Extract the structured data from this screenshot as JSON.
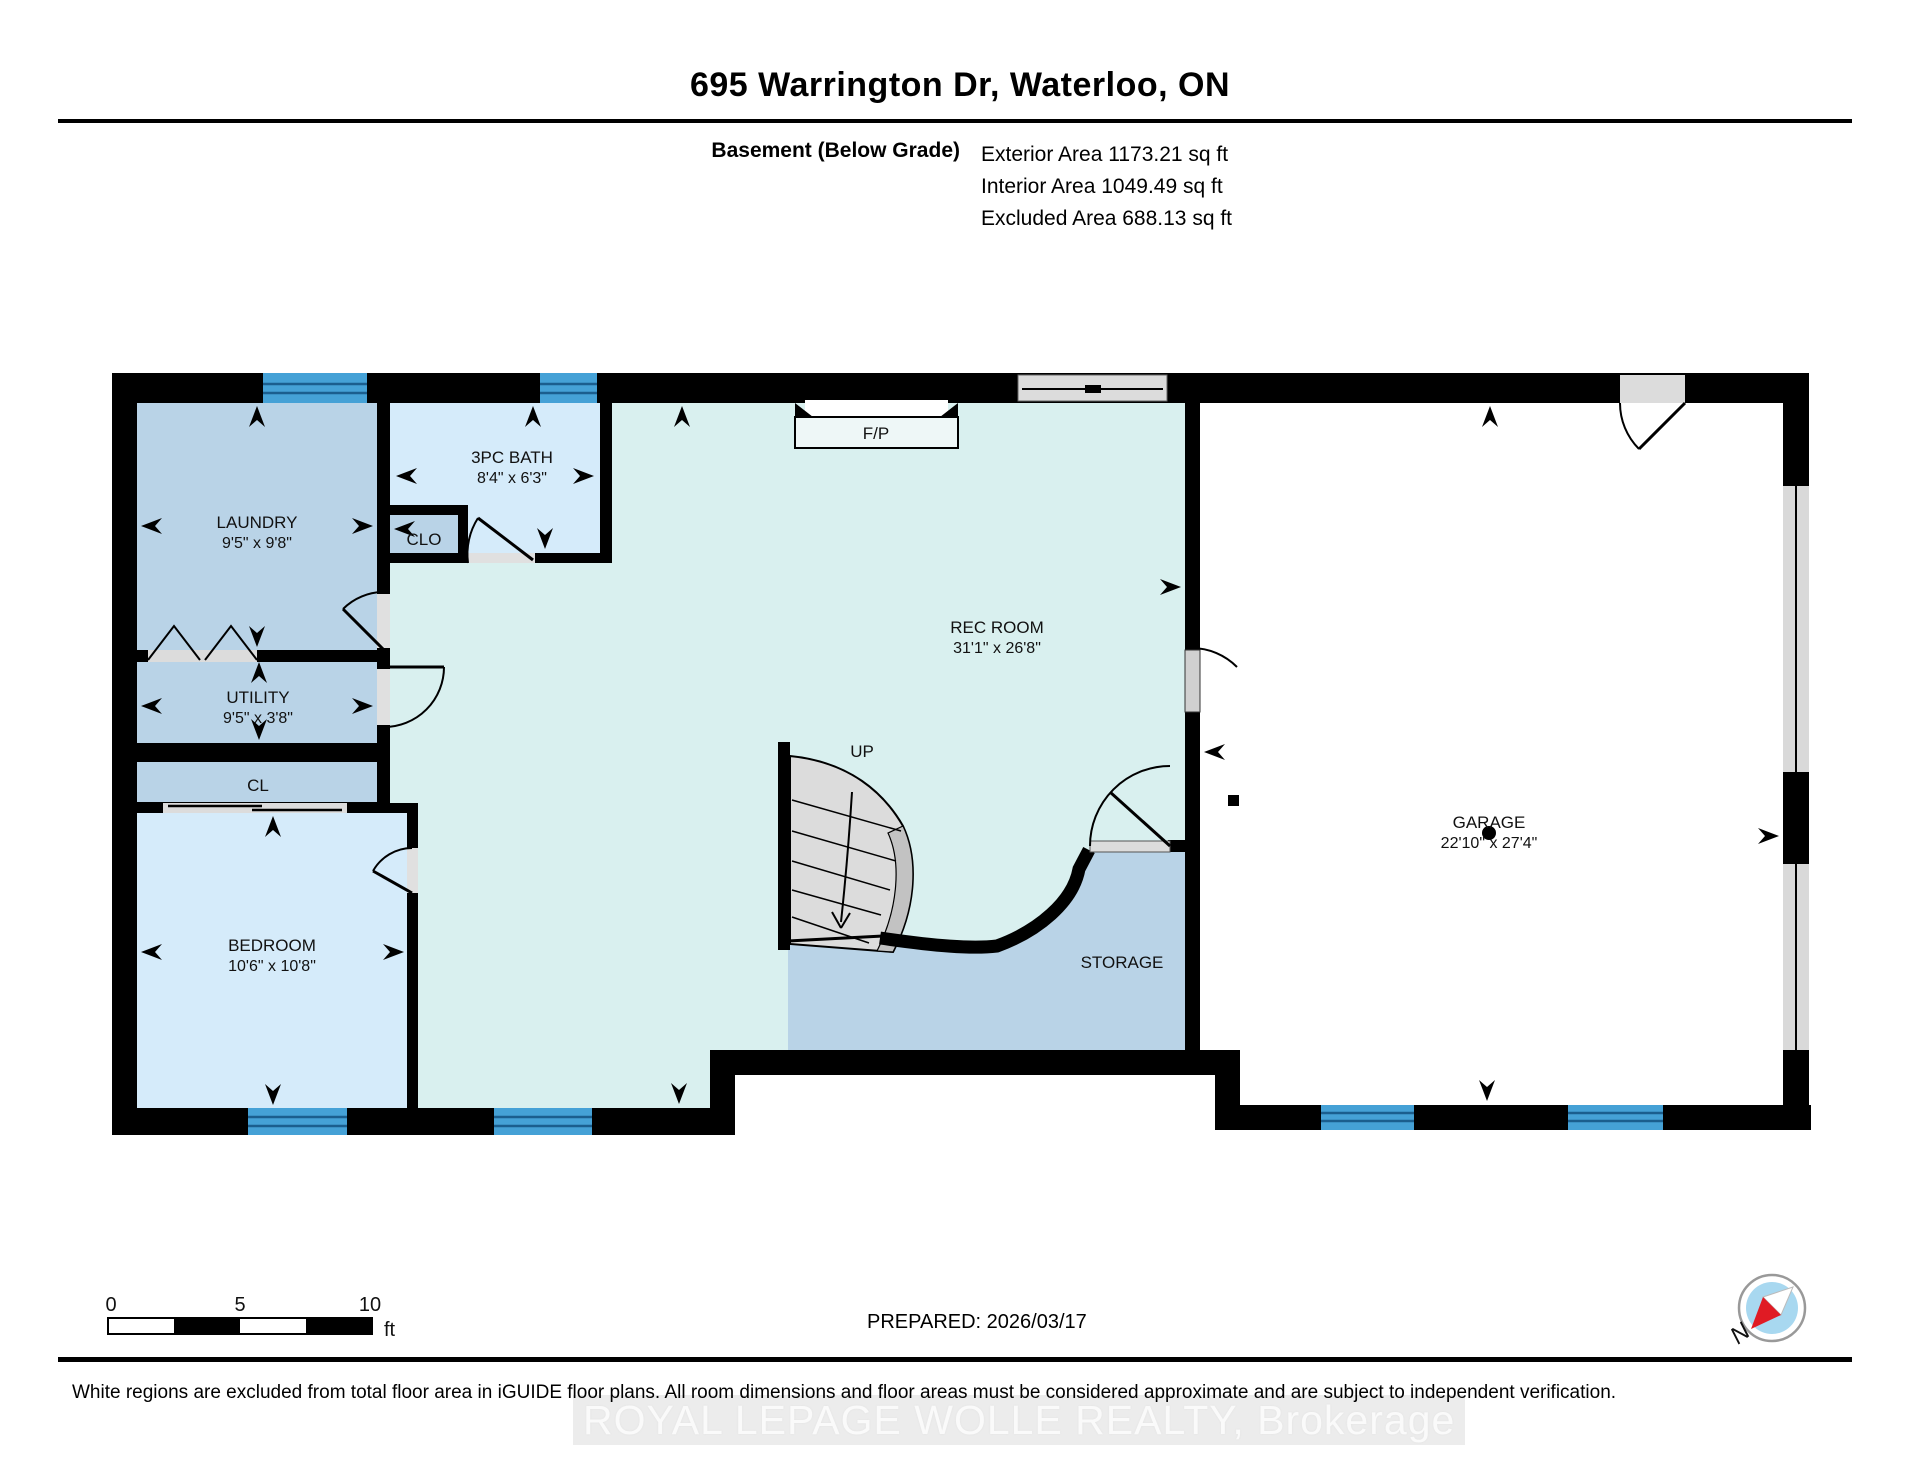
{
  "page": {
    "title": "695 Warrington Dr, Waterloo, ON"
  },
  "header": {
    "floor_label": "Basement (Below Grade)",
    "area_lines": [
      "Exterior Area 1173.21 sq ft",
      "Interior Area 1049.49 sq ft",
      "Excluded Area 688.13 sq ft"
    ]
  },
  "plan": {
    "rooms": [
      {
        "name": "LAUNDRY",
        "dims": "9'5\" x 9'8\""
      },
      {
        "name": "3PC BATH",
        "dims": "8'4\" x 6'3\""
      },
      {
        "name": "CLO",
        "dims": ""
      },
      {
        "name": "UTILITY",
        "dims": "9'5\" x 3'8\""
      },
      {
        "name": "CL",
        "dims": ""
      },
      {
        "name": "BEDROOM",
        "dims": "10'6\" x 10'8\""
      },
      {
        "name": "REC ROOM",
        "dims": "31'1\" x 26'8\""
      },
      {
        "name": "STORAGE",
        "dims": ""
      },
      {
        "name": "GARAGE",
        "dims": "22'10\" x 27'4\""
      }
    ],
    "stairs_label": "UP",
    "fireplace_label": "F/P"
  },
  "scale_bar": {
    "ticks": [
      "0",
      "5",
      "10"
    ],
    "unit": "ft"
  },
  "footer": {
    "prepared": "PREPARED: 2026/03/17",
    "compass_label": "N",
    "disclaimer": "White regions are excluded from total floor area in iGUIDE floor plans. All room dimensions and floor areas must be considered approximate and are subject to independent verification.",
    "watermark": "ROYAL LEPAGE WOLLE REALTY, Brokerage"
  },
  "colors": {
    "wall": "#000000",
    "window_blue": "#45a1d6",
    "window_line": "#1b5e8e",
    "room_blue": "#b9d3e7",
    "room_light_blue": "#d5ebfa",
    "room_teal": "#d9f0ef",
    "excluded_gray": "#dcdcdc",
    "compass_red": "#e01b24",
    "compass_blue": "#a8d8f0"
  }
}
